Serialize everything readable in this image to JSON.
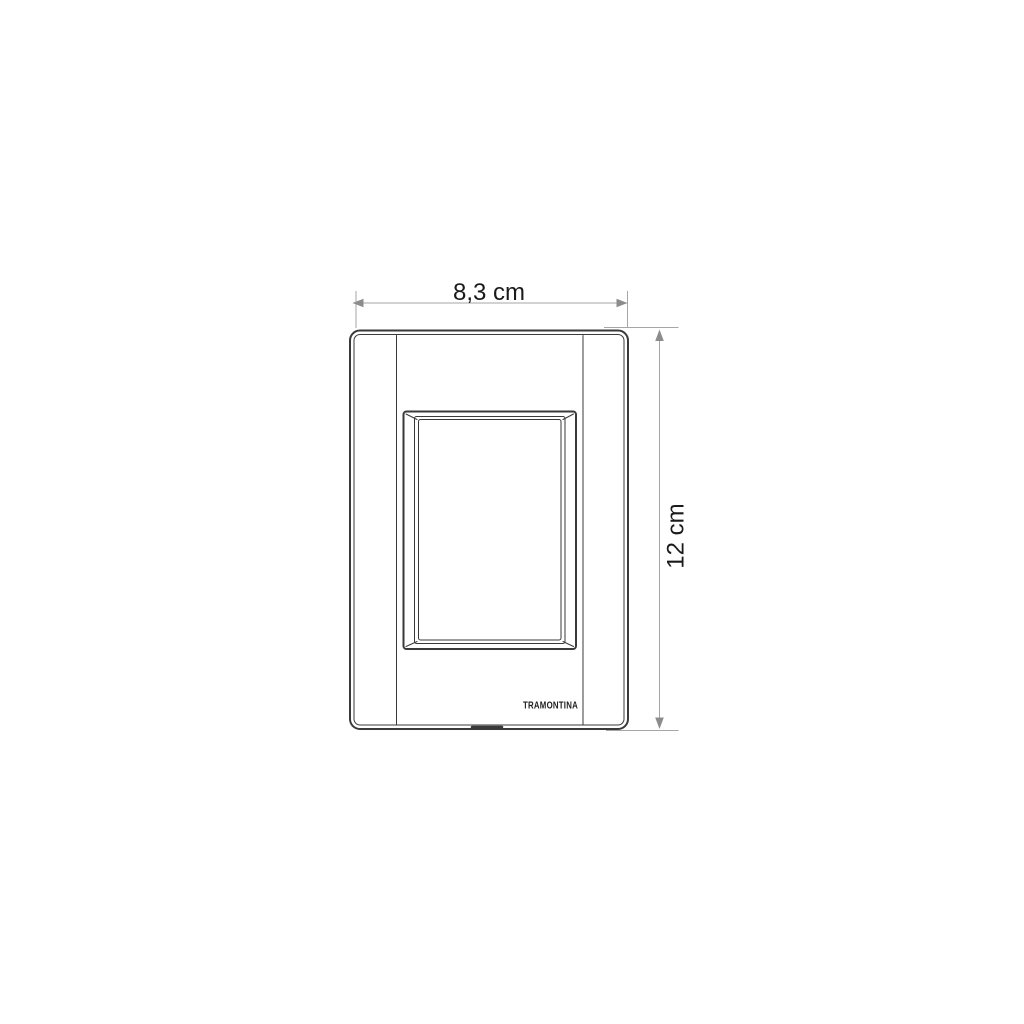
{
  "diagram": {
    "width_label": "8,3 cm",
    "height_label": "12 cm",
    "brand_label": "TRAMONTINA"
  },
  "colors": {
    "drawing_line": "#3a3a3a",
    "dimension_line": "#a6a6a6",
    "arrow": "#8c8c8c",
    "label_text": "#1a1a1a",
    "background": "#ffffff"
  }
}
